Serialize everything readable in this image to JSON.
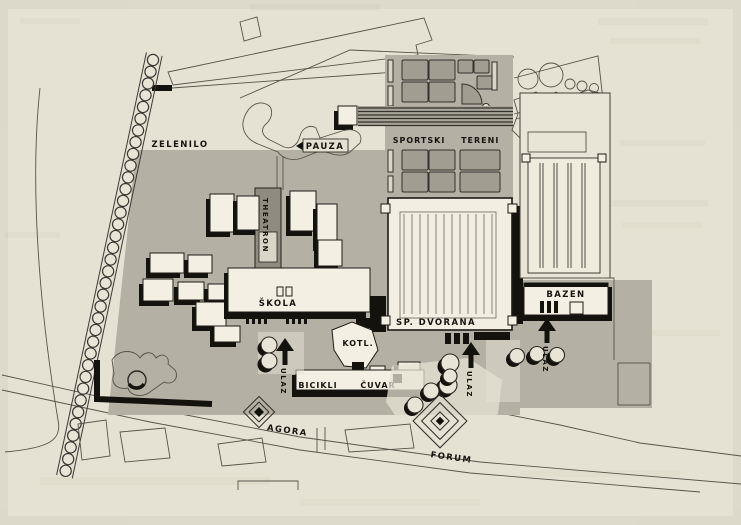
{
  "colors": {
    "paper": "#e6e2d3",
    "site_gray": "#b4b0a4",
    "court_gray": "#a19d91",
    "building_white": "#f3efe2",
    "ink_black": "#16140f",
    "line_gray": "#57534a"
  },
  "icons": {
    "entrance_arrow": "▲",
    "tree": "●",
    "fountain_diamond": "◆",
    "tree_avenue": "●●●"
  },
  "labels": {
    "zelenilo": "ZELENILO",
    "pauza": "PAUZA",
    "sportski_tereni": "SPORTSKI TERENI",
    "suncanje": "SUNČANJE",
    "theatron": "THEATRON",
    "skola": "ŠKOLA",
    "sp_dvorana": "SP. DVORANA",
    "bazen": "BAZEN",
    "kotl": "KOTL.",
    "bicikli": "BICIKLI",
    "cuvar": "ČUVAR",
    "agora": "AGORA",
    "forum": "FORUM"
  },
  "entrances": {
    "skola": "ULAZ",
    "dvorana": "ULAZ",
    "bazen": "ULAZ"
  }
}
